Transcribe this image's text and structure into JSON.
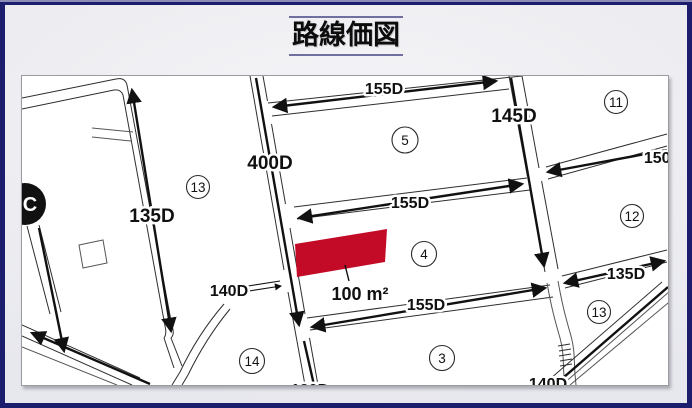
{
  "page": {
    "title": "路線価図"
  },
  "colors": {
    "frame_navy": "#1d1d6e",
    "title_rule": "#716fa0",
    "parcel_red": "#c30b28",
    "map_line": "#2e2e2e"
  },
  "map": {
    "labels": {
      "top155": "155D",
      "v400": "400D",
      "v145": "145D",
      "r150": "150D",
      "mid155": "155D",
      "left135": "135D",
      "btm155": "155D",
      "right135": "135D",
      "left140": "140D",
      "btm140": "140D",
      "btm130": "130D",
      "area": "100 m²",
      "c_mark": "C"
    },
    "zones": {
      "z5": "5",
      "z11": "11",
      "z12": "12",
      "z13_left": "13",
      "z13_right": "13",
      "z4": "4",
      "z3": "3",
      "z14": "14"
    }
  }
}
